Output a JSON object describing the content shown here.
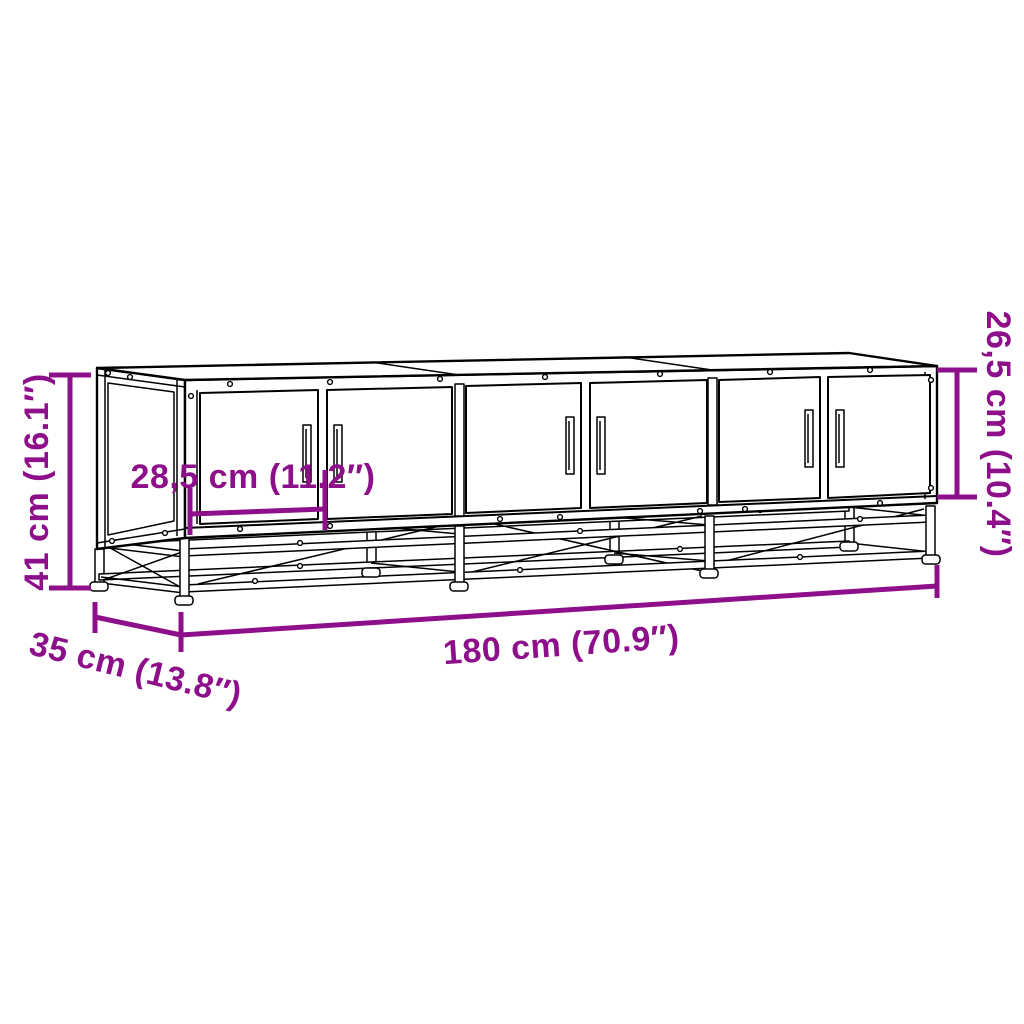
{
  "canvas": {
    "background": "#ffffff",
    "paper": "#ffffff",
    "width_px": 1024,
    "height_px": 1024
  },
  "drawing": {
    "subject": "tv-cabinet-six-doors-metal-frame-line-drawing",
    "line_color": "#000000"
  },
  "annotations": {
    "color": "#8E0F8A",
    "height": {
      "text": "41 cm (16.1″)",
      "cm": 41,
      "inches": 16.1
    },
    "door_width": {
      "text": "28,5 cm (11.2″)",
      "cm": 28.5,
      "inches": 11.2
    },
    "door_height": {
      "text": "26,5 cm (10.4″)",
      "cm": 26.5,
      "inches": 10.4
    },
    "width": {
      "text": "180 cm (70.9″)",
      "cm": 180,
      "inches": 70.9
    },
    "depth": {
      "text": "35 cm (13.8″)",
      "cm": 35,
      "inches": 13.8
    }
  }
}
